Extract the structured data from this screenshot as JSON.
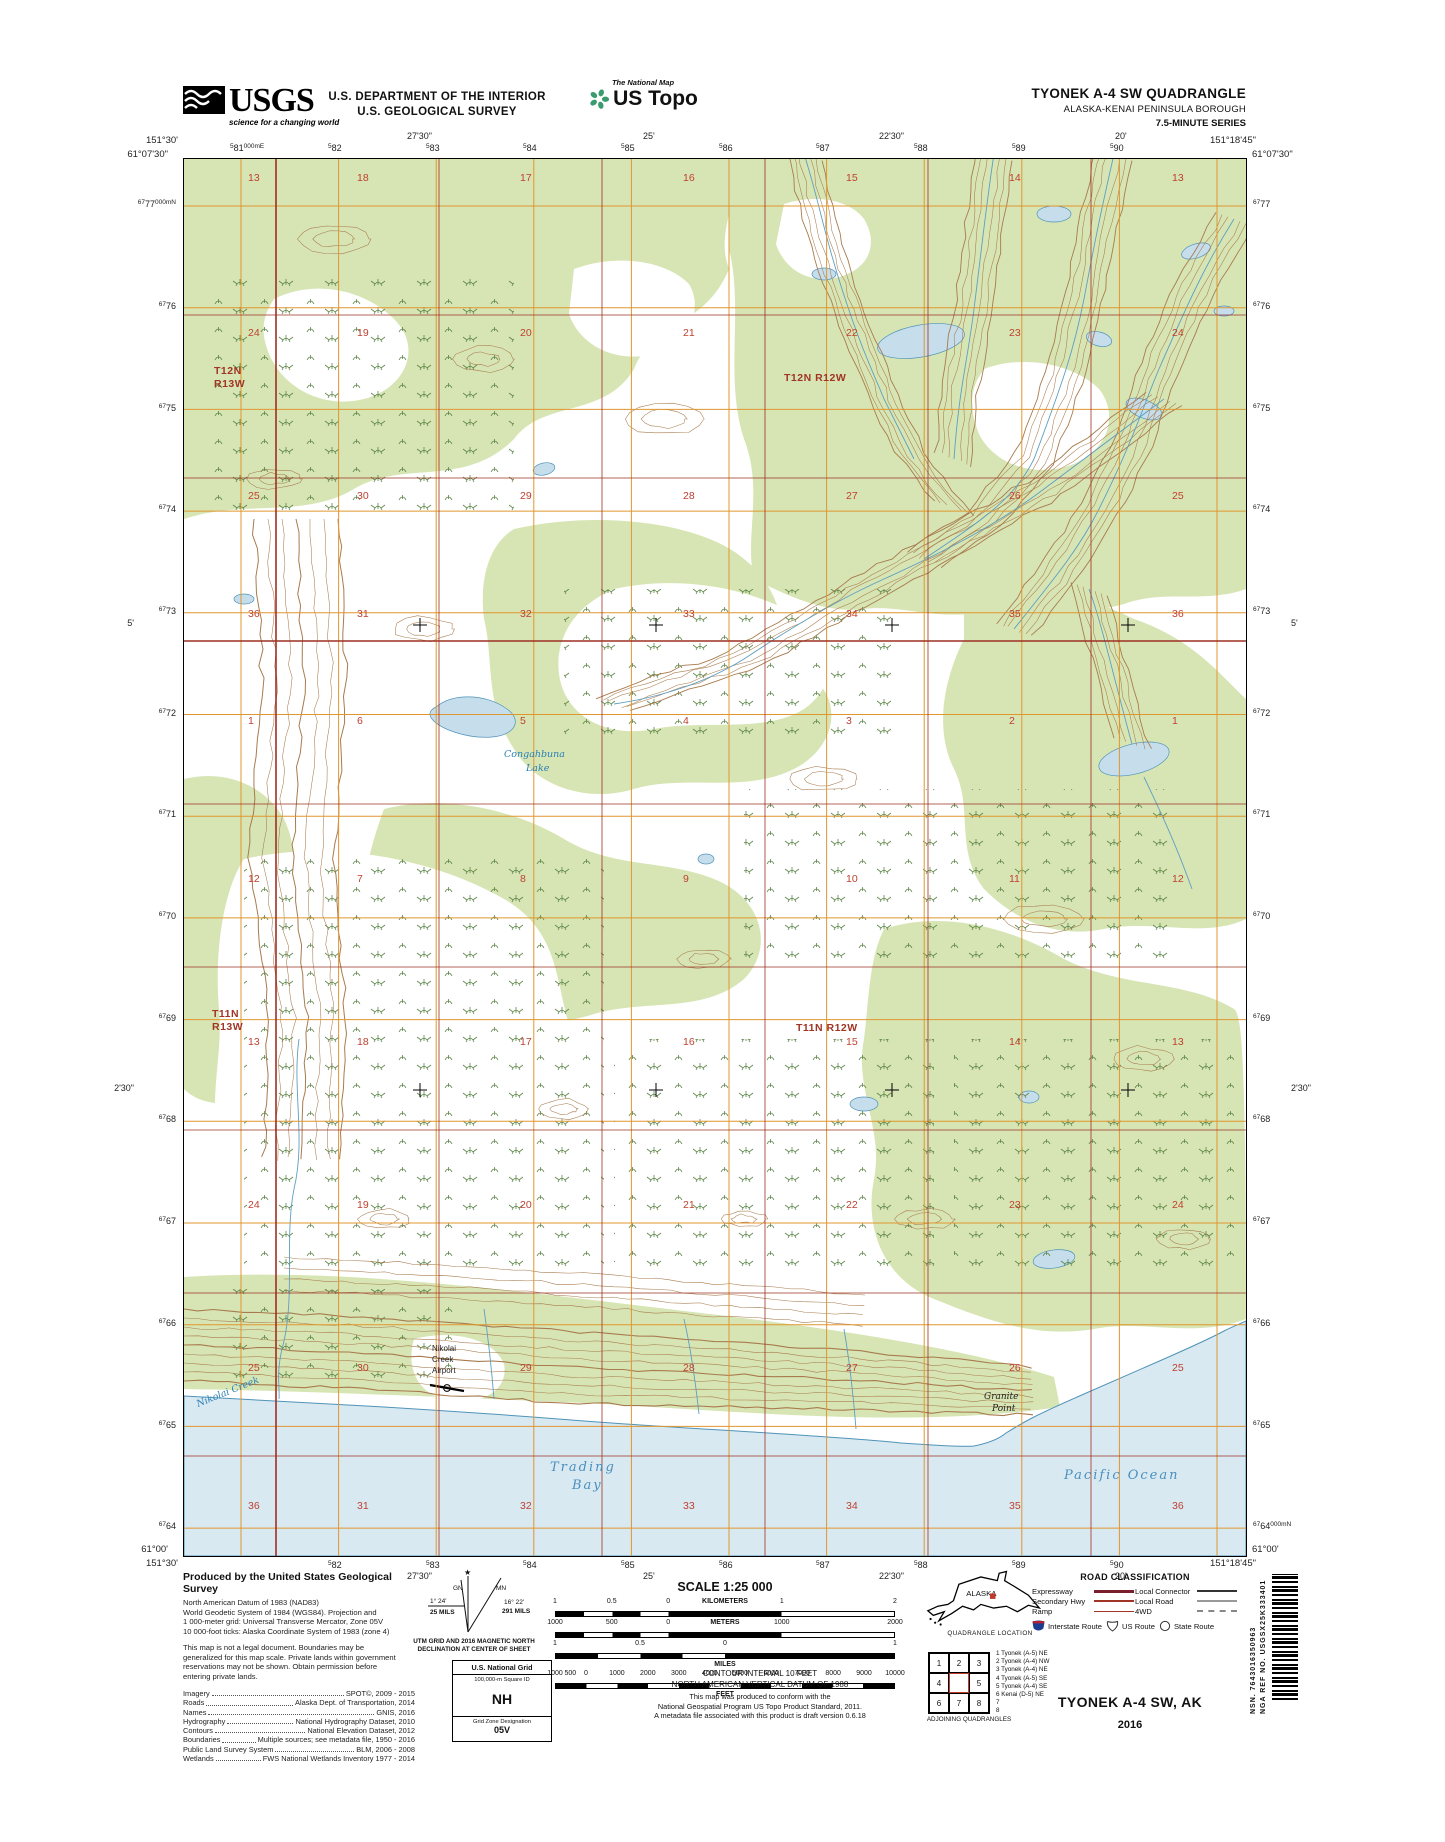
{
  "header": {
    "usgs_logo": {
      "text": "USGS",
      "tagline": "science for a changing world"
    },
    "department_line1": "U.S. DEPARTMENT OF THE INTERIOR",
    "department_line2": "U.S. GEOLOGICAL SURVEY",
    "program_small": "The National Map",
    "program_big": "US Topo",
    "quad_title": "TYONEK A-4 SW QUADRANGLE",
    "quad_subtitle1": "ALASKA-KENAI PENINSULA BOROUGH",
    "quad_subtitle2": "7.5-MINUTE SERIES"
  },
  "map": {
    "corners": {
      "nw_lon": "151°30'",
      "nw_lat": "61°07'30\"",
      "ne_lon": "151°18'45\"",
      "ne_lat": "61°07'30\"",
      "sw_lon": "151°30'",
      "sw_lat": "61°00'",
      "se_lon": "151°18'45\"",
      "se_lat": "61°00'"
    },
    "top_eastings": [
      {
        "pre": "5",
        "num": "81",
        "suf": "000m",
        "unit": "E",
        "x": 57
      },
      {
        "pre": "5",
        "num": "82",
        "x": 155
      },
      {
        "pre": "5",
        "num": "83",
        "x": 253
      },
      {
        "pre": "5",
        "num": "84",
        "x": 350
      },
      {
        "pre": "5",
        "num": "85",
        "x": 448
      },
      {
        "pre": "5",
        "num": "86",
        "x": 546
      },
      {
        "pre": "5",
        "num": "87",
        "x": 643
      },
      {
        "pre": "5",
        "num": "88",
        "x": 741
      },
      {
        "pre": "5",
        "num": "89",
        "x": 839
      },
      {
        "pre": "5",
        "num": "90",
        "x": 937
      }
    ],
    "bottom_eastings": [
      {
        "pre": "5",
        "num": "82",
        "x": 155
      },
      {
        "pre": "5",
        "num": "83",
        "x": 253
      },
      {
        "pre": "5",
        "num": "84",
        "x": 350
      },
      {
        "pre": "5",
        "num": "85",
        "x": 448
      },
      {
        "pre": "5",
        "num": "86",
        "x": 546
      },
      {
        "pre": "5",
        "num": "87",
        "x": 643
      },
      {
        "pre": "5",
        "num": "88",
        "x": 741
      },
      {
        "pre": "5",
        "num": "89",
        "x": 839
      },
      {
        "pre": "5",
        "num": "90",
        "x": 937
      }
    ],
    "top_minutes": [
      {
        "t": "27'30\"",
        "x": 236
      },
      {
        "t": "25'",
        "x": 472
      },
      {
        "t": "22'30\"",
        "x": 708
      },
      {
        "t": "20'",
        "x": 944
      }
    ],
    "bottom_minutes": [
      {
        "t": "27'30\"",
        "x": 236
      },
      {
        "t": "25'",
        "x": 472
      },
      {
        "t": "22'30\"",
        "x": 708
      },
      {
        "t": "20'",
        "x": 944
      }
    ],
    "left_northings": [
      {
        "pre": "67",
        "num": "77",
        "suf": "000m",
        "unit": "N",
        "y": 47
      },
      {
        "pre": "67",
        "num": "76",
        "y": 149
      },
      {
        "pre": "67",
        "num": "75",
        "y": 251
      },
      {
        "pre": "67",
        "num": "74",
        "y": 352
      },
      {
        "pre": "67",
        "num": "73",
        "y": 454
      },
      {
        "pre": "67",
        "num": "72",
        "y": 556
      },
      {
        "pre": "67",
        "num": "71",
        "y": 657
      },
      {
        "pre": "67",
        "num": "70",
        "y": 759
      },
      {
        "pre": "67",
        "num": "69",
        "y": 861
      },
      {
        "pre": "67",
        "num": "68",
        "y": 962
      },
      {
        "pre": "67",
        "num": "67",
        "y": 1064
      },
      {
        "pre": "67",
        "num": "66",
        "y": 1166
      },
      {
        "pre": "67",
        "num": "65",
        "y": 1268
      },
      {
        "pre": "67",
        "num": "64",
        "y": 1369
      }
    ],
    "right_northings": [
      {
        "pre": "67",
        "num": "77",
        "y": 47
      },
      {
        "pre": "67",
        "num": "76",
        "y": 149
      },
      {
        "pre": "67",
        "num": "75",
        "y": 251
      },
      {
        "pre": "67",
        "num": "74",
        "y": 352
      },
      {
        "pre": "67",
        "num": "73",
        "y": 454
      },
      {
        "pre": "67",
        "num": "72",
        "y": 556
      },
      {
        "pre": "67",
        "num": "71",
        "y": 657
      },
      {
        "pre": "67",
        "num": "70",
        "y": 759
      },
      {
        "pre": "67",
        "num": "69",
        "y": 861
      },
      {
        "pre": "67",
        "num": "68",
        "y": 962
      },
      {
        "pre": "67",
        "num": "67",
        "y": 1064
      },
      {
        "pre": "67",
        "num": "66",
        "y": 1166
      },
      {
        "pre": "67",
        "num": "65",
        "y": 1268
      },
      {
        "pre": "67",
        "num": "64",
        "suf": "000m",
        "unit": "N",
        "y": 1369
      }
    ],
    "left_minutes": [
      {
        "t": "5'",
        "y": 466
      },
      {
        "t": "2'30\"",
        "y": 931
      }
    ],
    "right_minutes": [
      {
        "t": "5'",
        "y": 466
      },
      {
        "t": "2'30\"",
        "y": 931
      }
    ],
    "townships": [
      {
        "lines": [
          "T12N",
          "R13W"
        ],
        "x": 30,
        "y": 215
      },
      {
        "lines": [
          "T12N R12W"
        ],
        "x": 600,
        "y": 222
      },
      {
        "lines": [
          "T11N",
          "R13W"
        ],
        "x": 28,
        "y": 858
      },
      {
        "lines": [
          "T11N R12W"
        ],
        "x": 612,
        "y": 872
      }
    ],
    "section_cols": [
      64,
      173,
      336,
      499,
      662,
      825,
      988
    ],
    "section_rows": [
      {
        "y": 22,
        "nums": [
          "13",
          "18",
          "17",
          "16",
          "15",
          "14",
          "13"
        ]
      },
      {
        "y": 177,
        "nums": [
          "24",
          "19",
          "20",
          "21",
          "22",
          "23",
          "24"
        ]
      },
      {
        "y": 340,
        "nums": [
          "25",
          "30",
          "29",
          "28",
          "27",
          "26",
          "25"
        ]
      },
      {
        "y": 458,
        "nums": [
          "36",
          "31",
          "32",
          "33",
          "34",
          "35",
          "36"
        ]
      },
      {
        "y": 565,
        "nums": [
          "1",
          "6",
          "5",
          "4",
          "3",
          "2",
          "1"
        ]
      },
      {
        "y": 723,
        "nums": [
          "12",
          "7",
          "8",
          "9",
          "10",
          "11",
          "12"
        ]
      },
      {
        "y": 886,
        "nums": [
          "13",
          "18",
          "17",
          "16",
          "15",
          "14",
          "13"
        ]
      },
      {
        "y": 1049,
        "nums": [
          "24",
          "19",
          "20",
          "21",
          "22",
          "23",
          "24"
        ]
      },
      {
        "y": 1212,
        "nums": [
          "25",
          "30",
          "29",
          "28",
          "27",
          "26",
          "25"
        ]
      },
      {
        "y": 1350,
        "nums": [
          "36",
          "31",
          "32",
          "33",
          "34",
          "35",
          "36"
        ]
      }
    ],
    "places": [
      {
        "t": "Congahbuna",
        "x": 320,
        "y": 598,
        "cls": "wl"
      },
      {
        "t": "Lake",
        "x": 342,
        "y": 612,
        "cls": "wl"
      },
      {
        "t": "Nikolai",
        "x": 248,
        "y": 1192,
        "cls": "fl"
      },
      {
        "t": "Creek",
        "x": 248,
        "y": 1203,
        "cls": "fl"
      },
      {
        "t": "Airport",
        "x": 248,
        "y": 1214,
        "cls": "fl"
      },
      {
        "t": "Nikolai Creek",
        "x": 14,
        "y": 1248,
        "cls": "wl",
        "rot": -22
      },
      {
        "t": "Trading",
        "x": 366,
        "y": 1312,
        "cls": "wl2"
      },
      {
        "t": "Bay",
        "x": 388,
        "y": 1330,
        "cls": "wl2"
      },
      {
        "t": "Granite",
        "x": 800,
        "y": 1240,
        "cls": "fli"
      },
      {
        "t": "Point",
        "x": 808,
        "y": 1252,
        "cls": "fli"
      },
      {
        "t": "Pacific Ocean",
        "x": 880,
        "y": 1320,
        "cls": "wl2"
      }
    ]
  },
  "footer": {
    "producer": {
      "title": "Produced by the United States Geological Survey",
      "datum_lines": [
        "North American Datum of 1983 (NAD83)",
        "World Geodetic System of 1984 (WGS84).  Projection and",
        "1 000-meter grid: Universal Transverse Mercator, Zone 05V",
        "10 000-foot ticks: Alaska Coordinate System of 1983 (zone 4)"
      ],
      "legal_lines": [
        "This map is not a legal document. Boundaries may be",
        "generalized for this map scale. Private lands within government",
        "reservations may not be shown. Obtain permission before",
        "entering private lands."
      ],
      "credits": [
        {
          "label": "Imagery",
          "value": "SPOT©,  2009 - 2015"
        },
        {
          "label": "Roads",
          "value": "Alaska  Dept.  of  Transportation,  2014"
        },
        {
          "label": "Names",
          "value": "GNIS,  2016"
        },
        {
          "label": "Hydrography",
          "value": "National  Hydrography  Dataset,  2010"
        },
        {
          "label": "Contours",
          "value": "National  Elevation  Dataset,  2012"
        },
        {
          "label": "Boundaries",
          "value": "Multiple sources; see metadata file, 1950 - 2016"
        },
        {
          "label": "Public Land Survey System",
          "value": "BLM,  2006 - 2008"
        },
        {
          "label": "Wetlands",
          "value": "FWS  National  Wetlands  Inventory  1977 - 2014"
        }
      ]
    },
    "declination": {
      "star": "★",
      "gn": "GN",
      "mn": "MN",
      "gn_deg": "1° 24'",
      "gn_mils": "25 MILS",
      "mn_deg": "16° 22'",
      "mn_mils": "291 MILS",
      "caption1": "UTM GRID AND 2016 MAGNETIC NORTH",
      "caption2": "DECLINATION AT CENTER OF SHEET"
    },
    "usng": {
      "title": "U.S. National Grid",
      "sub": "100,000-m Square ID",
      "square": "NH",
      "zone_label": "Grid Zone Designation",
      "zone": "05V"
    },
    "scale": {
      "title": "SCALE 1:25 000",
      "rows": [
        {
          "unit": "KILOMETERS",
          "unit_pos": 50,
          "bar": "km",
          "unit_below": false,
          "ticks": [
            {
              "t": "1",
              "p": 0
            },
            {
              "t": "0.5",
              "p": 16.7
            },
            {
              "t": "0",
              "p": 33.3
            },
            {
              "t": "1",
              "p": 66.7
            },
            {
              "t": "2",
              "p": 100
            }
          ]
        },
        {
          "unit": "METERS",
          "unit_pos": 50,
          "bar": "m",
          "unit_below": false,
          "ticks": [
            {
              "t": "1000",
              "p": 0
            },
            {
              "t": "500",
              "p": 16.7
            },
            {
              "t": "0",
              "p": 33.3
            },
            {
              "t": "1000",
              "p": 66.7
            },
            {
              "t": "2000",
              "p": 100
            }
          ]
        },
        {
          "unit": "MILES",
          "bar": "mi",
          "unit_below": true,
          "ticks": [
            {
              "t": "1",
              "p": 0
            },
            {
              "t": "0.5",
              "p": 25
            },
            {
              "t": "0",
              "p": 50
            },
            {
              "t": "1",
              "p": 100
            }
          ]
        },
        {
          "unit": "FEET",
          "bar": "ft",
          "unit_below": true,
          "ticks": [
            {
              "t": "1000",
              "p": 0
            },
            {
              "t": "500",
              "p": 4.5
            },
            {
              "t": "0",
              "p": 9.1
            },
            {
              "t": "1000",
              "p": 18.2
            },
            {
              "t": "2000",
              "p": 27.3
            },
            {
              "t": "3000",
              "p": 36.4
            },
            {
              "t": "4000",
              "p": 45.5
            },
            {
              "t": "5000",
              "p": 54.5
            },
            {
              "t": "6000",
              "p": 63.6
            },
            {
              "t": "7000",
              "p": 72.7
            },
            {
              "t": "8000",
              "p": 81.8
            },
            {
              "t": "9000",
              "p": 90.9
            },
            {
              "t": "10000",
              "p": 100
            }
          ]
        }
      ]
    },
    "contour_line1": "CONTOUR INTERVAL 10 FEET",
    "contour_line2": "NORTH AMERICAN VERTICAL DATUM OF 1988",
    "conformance": [
      "This map was produced to conform with the",
      "National Geospatial Program US Topo Product Standard, 2011.",
      "A metadata file associated with this product is draft version 0.6.18"
    ],
    "location": {
      "label": "ALASKA",
      "caption": "QUADRANGLE LOCATION"
    },
    "adjoining": {
      "caption": "ADJOINING QUADRANGLES",
      "cells": [
        "1",
        "2",
        "3",
        "4",
        "",
        "5",
        "6",
        "7",
        "8"
      ],
      "names": [
        "1 Tyonek (A-5) NE",
        "2 Tyonek (A-4) NW",
        "3 Tyonek (A-4) NE",
        "4 Tyonek (A-5) SE",
        "5 Tyonek (A-4) SE",
        "6 Kenai (D-5) NE",
        "7",
        "8"
      ]
    },
    "roads": {
      "title": "ROAD CLASSIFICATION",
      "rows_left": [
        "Expressway",
        "Secondary Hwy",
        "Ramp"
      ],
      "rows_right": [
        "Local Connector",
        "Local Road",
        "4WD"
      ],
      "shields": [
        "Interstate Route",
        "US Route",
        "State Route"
      ]
    },
    "sheet": {
      "name": "TYONEK A-4 SW, AK",
      "year": "2016"
    },
    "edge_ids": {
      "nsn": "NSN. 7643016350963",
      "nga": "NGA REF NO. USGSX25K333401"
    }
  },
  "colors": {
    "vegetation_green": "#d7e5b4",
    "ocean_blue": "#d9e9f1",
    "lake_fill": "#c6deec",
    "water_line": "#4f93b8",
    "contour_brown": "#a87b4e",
    "utm_grid_orange": "#e0962f",
    "plss_red": "#9e3023",
    "section_number_red": "#bf4030",
    "wetland_green": "#55803f"
  }
}
